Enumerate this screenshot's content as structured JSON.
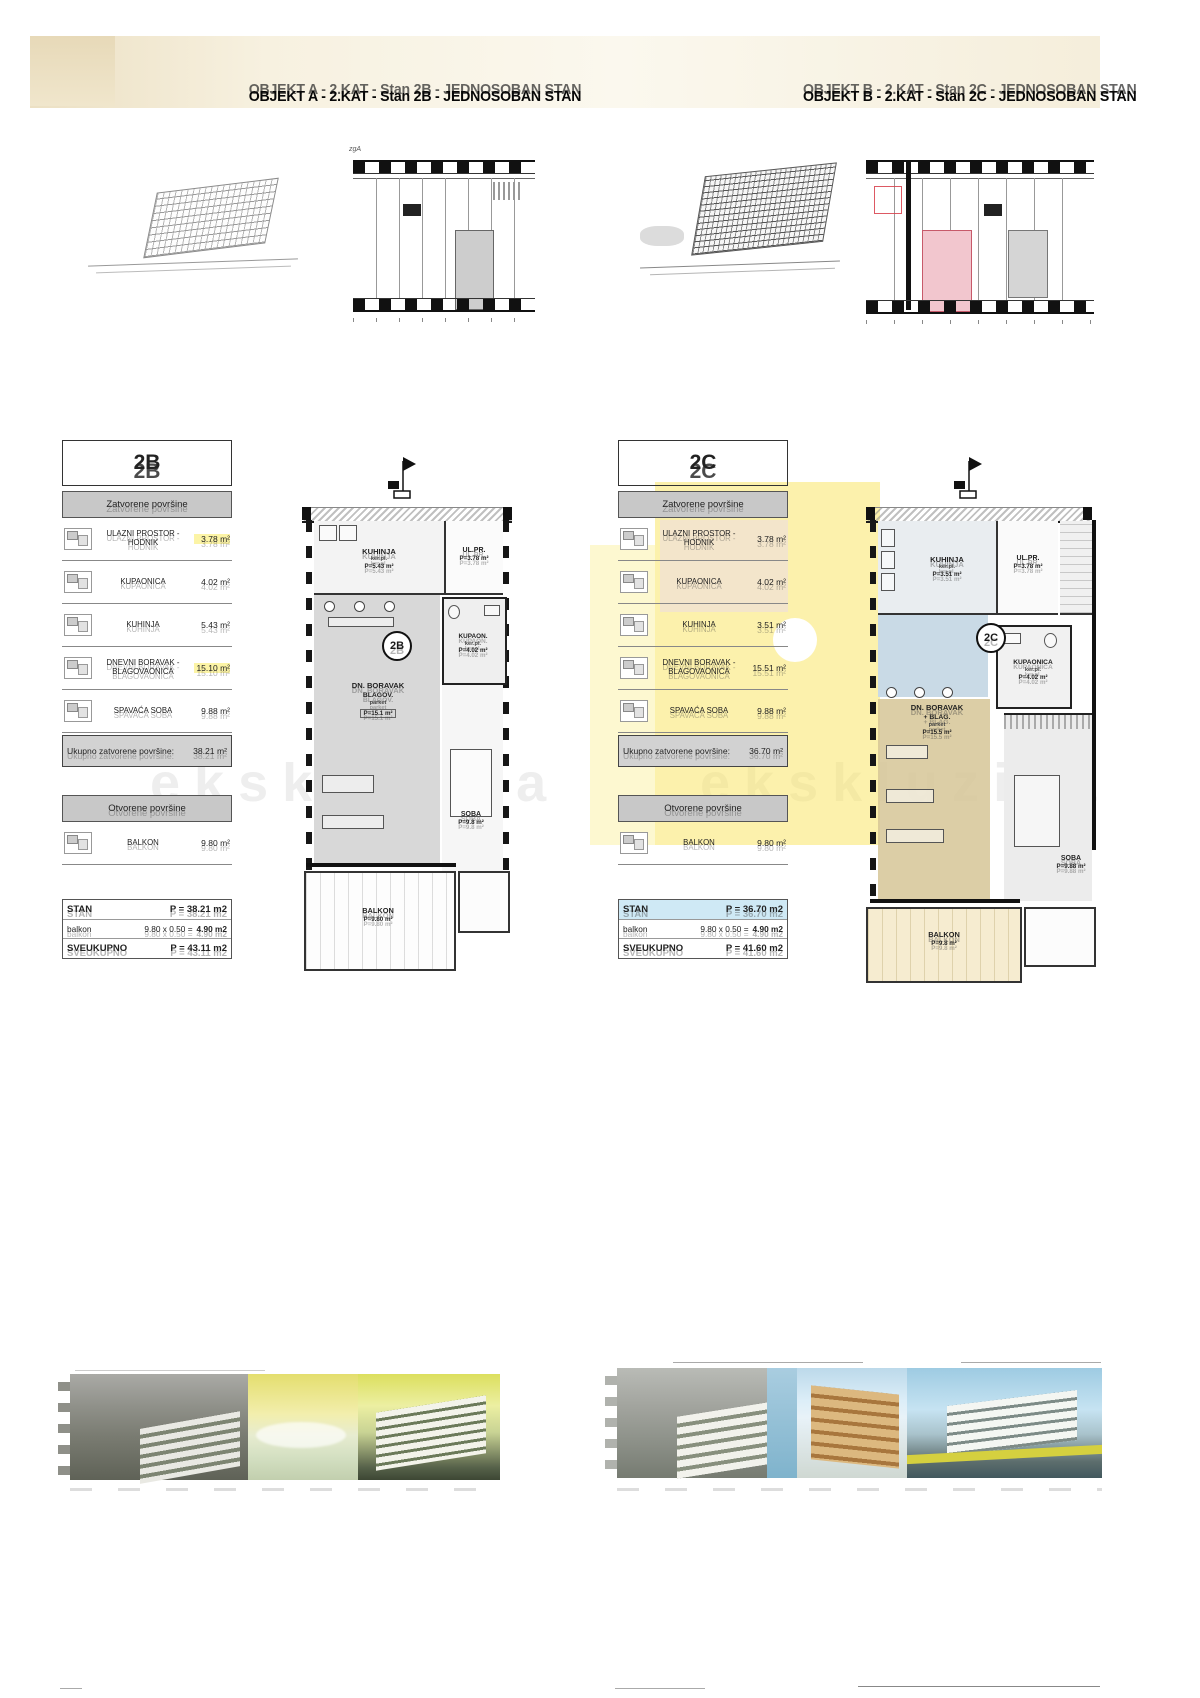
{
  "doc": {
    "watermark": "ekskluziva",
    "columns": [
      {
        "title": "OBJEKT A - 2.KAT - Stan 2B - JEDNOSOBAN STAN",
        "key_label": "zgA",
        "unit": "2B",
        "sections": {
          "closed": "Zatvorene površine",
          "open": "Otvorene površine",
          "total_label": "Ukupno zatvorene površine:",
          "total_value": "38.21 m²"
        },
        "rows": [
          {
            "label": "ULAZNI PROSTOR - HODNIK",
            "value": "3.78 m²"
          },
          {
            "label": "KUPAONICA",
            "value": "4.02 m²"
          },
          {
            "label": "KUHINJA",
            "value": "5.43 m²"
          },
          {
            "label": "DNEVNI BORAVAK - BLAGOVAONICA",
            "value": "15.10 m²"
          },
          {
            "label": "SPAVAĆA SOBA",
            "value": "9.88 m²"
          }
        ],
        "open_row": {
          "label": "BALKON",
          "value": "9.80 m²"
        },
        "summary": [
          {
            "name": "STAN",
            "calc": "",
            "result": "P = 38.21 m2"
          },
          {
            "name": "balkon",
            "calc": "9.80 x 0.50 =",
            "result": "4.90 m2"
          },
          {
            "name": "SVEUKUPNO",
            "calc": "",
            "result": "P = 43.11 m2"
          }
        ],
        "plan": {
          "kuhinja": "KUHINJA",
          "kuhinja_fin": "ker.pl.",
          "kuhinja_area": "P=5.43 m²",
          "ulaz": "UL.PR.",
          "ulaz_area": "P=3.78 m²",
          "badge": "2B",
          "kupaonica": "KUPAON.",
          "kupaonica_fin": "ker.pl.",
          "kupaonica_area": "P=4.02 m²",
          "dnevni": "DN. BORAVAK",
          "dnevni_sub": "BLAGOV.",
          "dnevni_fin": "parket",
          "dnevni_area": "P=15.1 m²",
          "soba": "SOBA",
          "soba_area": "P=9.8 m²",
          "balkon": "BALKON",
          "balkon_area": "P=9.80 m²"
        }
      },
      {
        "title": "OBJEKT B - 2.KAT - Stan 2C - JEDNOSOBAN STAN",
        "key_label": "",
        "unit": "2C",
        "sections": {
          "closed": "Zatvorene površine",
          "open": "Otvorene površine",
          "total_label": "Ukupno zatvorene površine:",
          "total_value": "36.70 m²"
        },
        "rows": [
          {
            "label": "ULAZNI PROSTOR - HODNIK",
            "value": "3.78 m²"
          },
          {
            "label": "KUPAONICA",
            "value": "4.02 m²"
          },
          {
            "label": "KUHINJA",
            "value": "3.51 m²"
          },
          {
            "label": "DNEVNI BORAVAK - BLAGOVAONICA",
            "value": "15.51 m²"
          },
          {
            "label": "SPAVAĆA SOBA",
            "value": "9.88 m²"
          }
        ],
        "open_row": {
          "label": "BALKON",
          "value": "9.80 m²"
        },
        "summary": [
          {
            "name": "STAN",
            "calc": "",
            "result": "P = 36.70 m2"
          },
          {
            "name": "balkon",
            "calc": "9.80 x 0.50 =",
            "result": "4.90 m2"
          },
          {
            "name": "SVEUKUPNO",
            "calc": "",
            "result": "P = 41.60 m2"
          }
        ],
        "plan": {
          "kuhinja": "KUHINJA",
          "kuhinja_fin": "ker.pl.",
          "kuhinja_area": "P=3.51 m²",
          "ulaz": "UL.PR.",
          "ulaz_area": "P=3.78 m²",
          "badge": "2C",
          "kupaonica": "KUPAONICA",
          "kupaonica_fin": "ker.pl.",
          "kupaonica_area": "P=4.02 m²",
          "dnevni": "DN. BORAVAK",
          "dnevni_sub": "+ BLAG.",
          "dnevni_fin": "parket",
          "dnevni_area": "P=15.5 m²",
          "soba": "SOBA",
          "soba_area": "P=9.88 m²",
          "balkon": "BALKON",
          "balkon_area": "P=9.8 m²"
        }
      }
    ]
  }
}
